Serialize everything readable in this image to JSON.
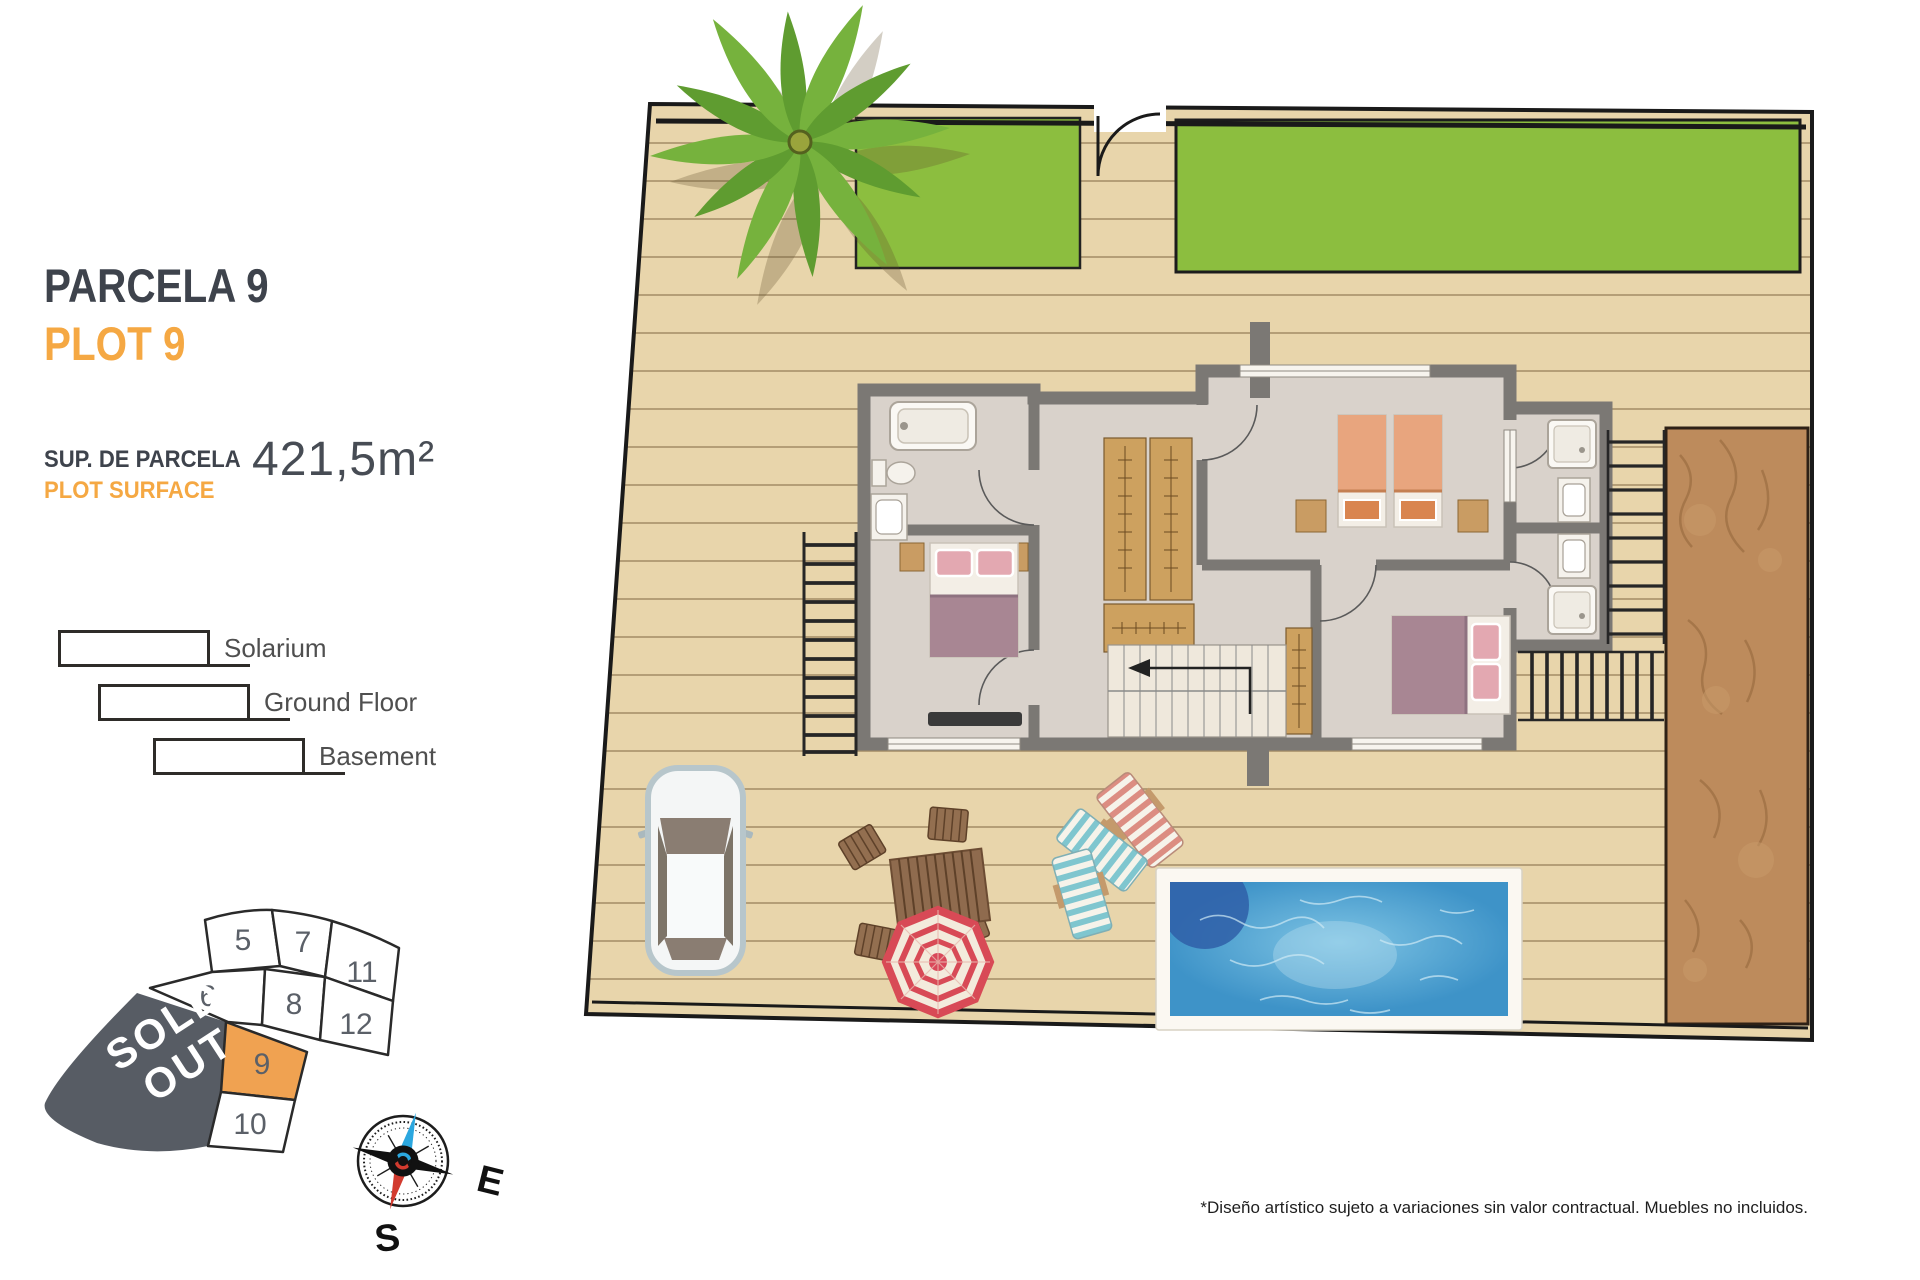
{
  "info": {
    "title_primary": "PARCELA 9",
    "title_secondary": "PLOT 9",
    "surface_label_primary": "SUP. DE PARCELA",
    "surface_label_secondary": "PLOT SURFACE",
    "surface_value": "421,5m²"
  },
  "legend": {
    "items": [
      {
        "label": "Solarium"
      },
      {
        "label": "Ground Floor"
      },
      {
        "label": "Basement"
      }
    ]
  },
  "minimap": {
    "sold_out_line1": "SOLD",
    "sold_out_line2": "OUT",
    "highlighted_plot": "9",
    "plots": [
      {
        "label": "5"
      },
      {
        "label": "7"
      },
      {
        "label": "11"
      },
      {
        "label": "6"
      },
      {
        "label": "8"
      },
      {
        "label": "12"
      },
      {
        "label": "9"
      },
      {
        "label": "10"
      }
    ]
  },
  "compass": {
    "east": "E",
    "south": "S"
  },
  "footer": {
    "disclaimer": "*Diseño artístico sujeto a variaciones sin valor contractual. Muebles no incluidos."
  },
  "colors": {
    "accent_orange": "#F5A843",
    "heading_dark": "#3E434C",
    "sold_out_bg": "#575C64",
    "plot_highlight": "#F0A251",
    "lawn_green": "#8CBE3F",
    "deck_tan": "#E8D5AB",
    "pool_blue": "#3E93C8",
    "dirt_brown": "#BD8B5C",
    "wall_gray": "#7B7874"
  }
}
